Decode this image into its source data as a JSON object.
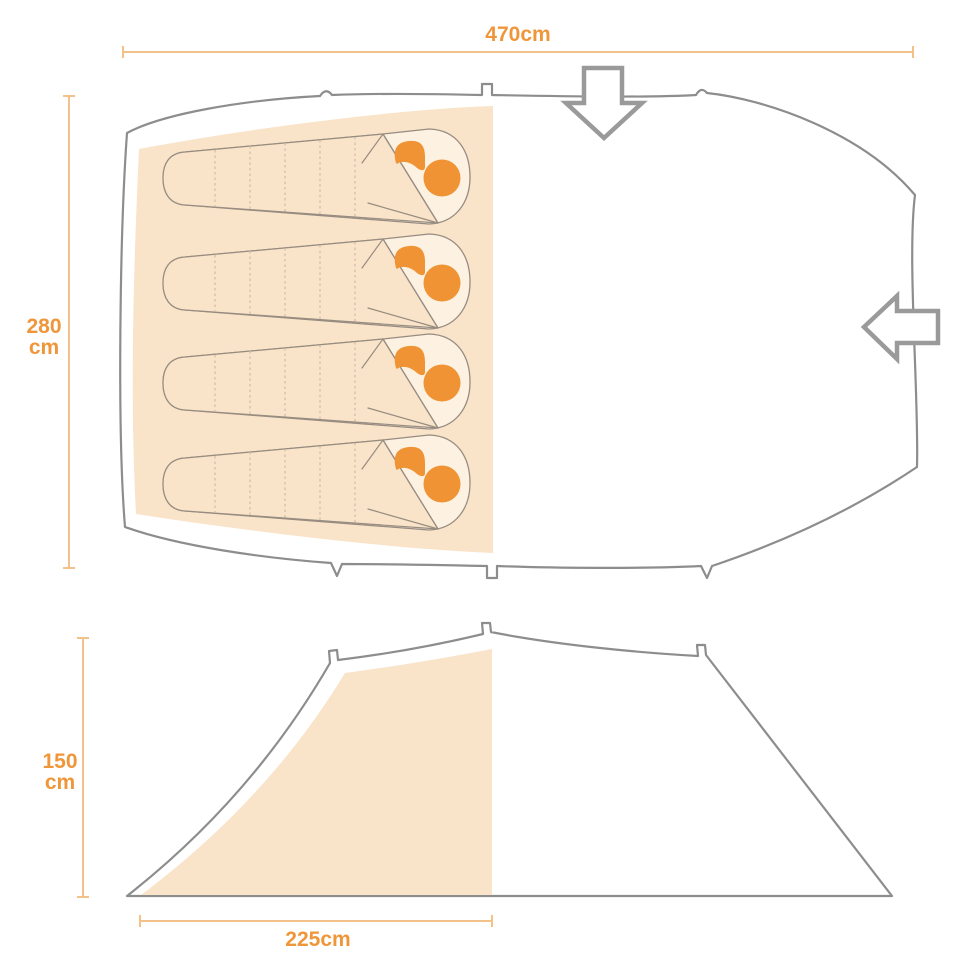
{
  "colors": {
    "accent": "#f0963a",
    "accent_strong": "#ef9334",
    "dim_line": "#f3c18a",
    "peach": "#f9e3c9",
    "bag_light": "#fdf1e2",
    "outline": "#8d8d8d",
    "bag_outline": "#978c80",
    "seam": "#cdbba3",
    "arrow": "#9a9a9a"
  },
  "top_view": {
    "width_label": "470cm",
    "depth_label": [
      "280",
      "cm"
    ],
    "sleeping_bag_count": 4,
    "entrance_arrows": [
      "down-arrow-icon",
      "left-arrow-icon"
    ]
  },
  "side_view": {
    "height_label": [
      "150",
      "cm"
    ],
    "bedroom_width_label": "225cm"
  }
}
